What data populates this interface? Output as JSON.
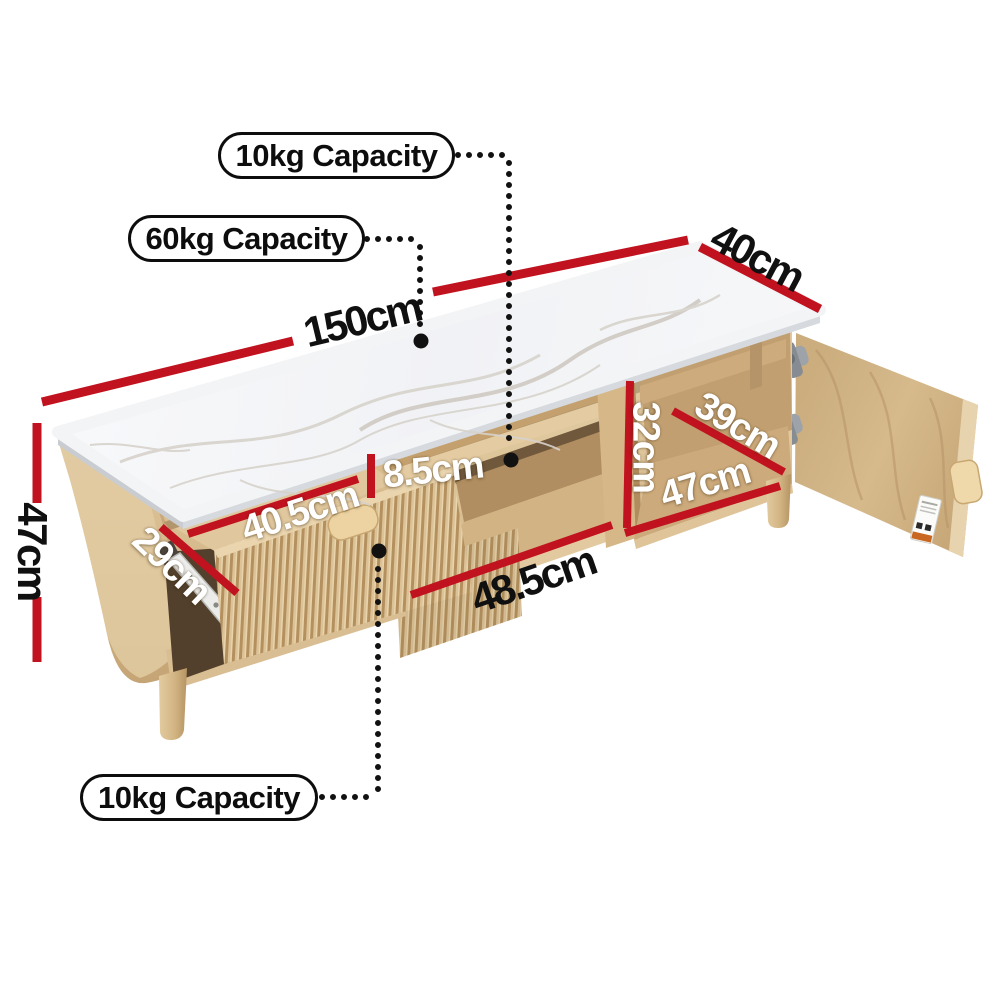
{
  "furniture": {
    "alt": "Wooden TV entertainment unit with white marble-look top, open fluted drawer, open shelves and an opened cabinet door, annotated with dimensions"
  },
  "badges": {
    "top": "10kg Capacity",
    "middle": "60kg Capacity",
    "bottom": "10kg Capacity"
  },
  "dims": {
    "top_length": "150cm",
    "top_depth": "40cm",
    "overall_height": "47cm",
    "drawer_side": "29cm",
    "drawer_width": "40.5cm",
    "top_shelf_height": "8.5cm",
    "shelf_width": "48.5cm",
    "cabinet_height": "32cm",
    "cabinet_depth": "39cm",
    "cabinet_width": "47cm"
  },
  "colors": {
    "accent_red": "#C1121F",
    "leader_black": "#111111",
    "wood": "#D7BB8E",
    "marble": "#F4F5F7",
    "background": "#FFFFFF"
  }
}
